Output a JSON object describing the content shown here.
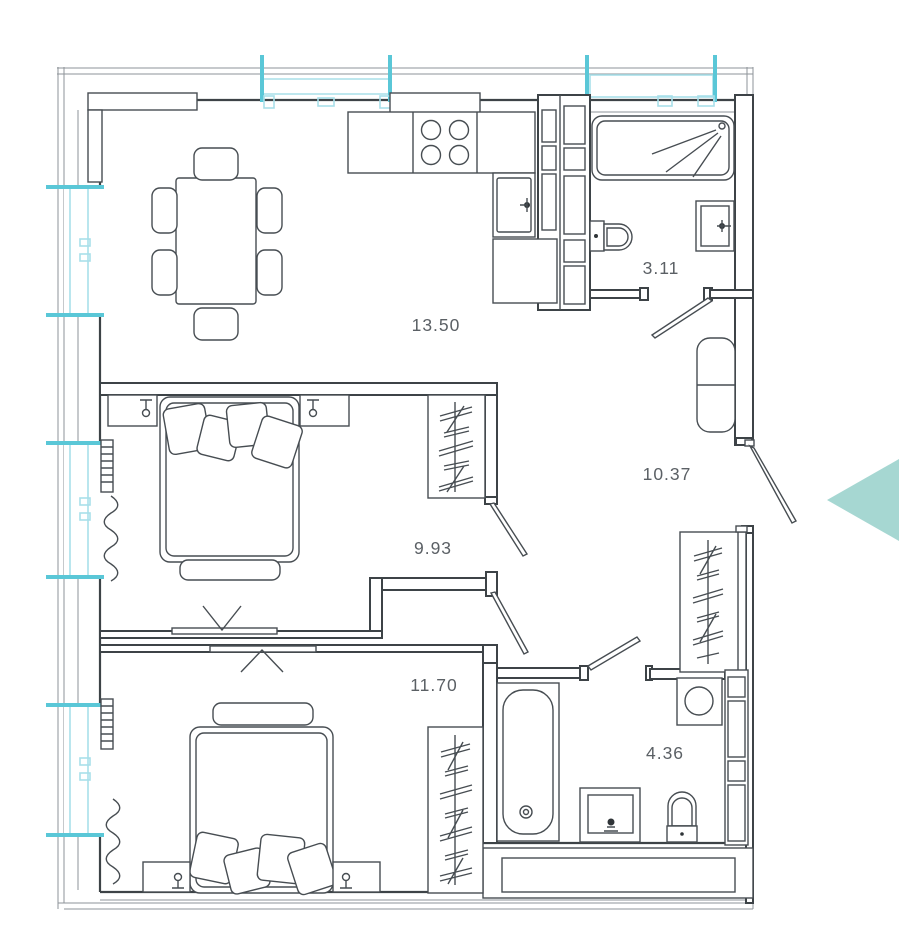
{
  "rooms": [
    {
      "id": "kitchen-living-room",
      "area": "13.50"
    },
    {
      "id": "bathroom-small",
      "area": "3.11"
    },
    {
      "id": "hallway",
      "area": "10.37"
    },
    {
      "id": "bedroom-1",
      "area": "9.93"
    },
    {
      "id": "bedroom-2",
      "area": "11.70"
    },
    {
      "id": "bathroom-main",
      "area": "4.36"
    }
  ],
  "colors": {
    "window_accent": "#5ac7d7",
    "window_frame_light": "#a8dfe9",
    "entrance_arrow": "#a6d7d2",
    "drawing_line": "#3d4347",
    "label_text": "#5b6065"
  }
}
